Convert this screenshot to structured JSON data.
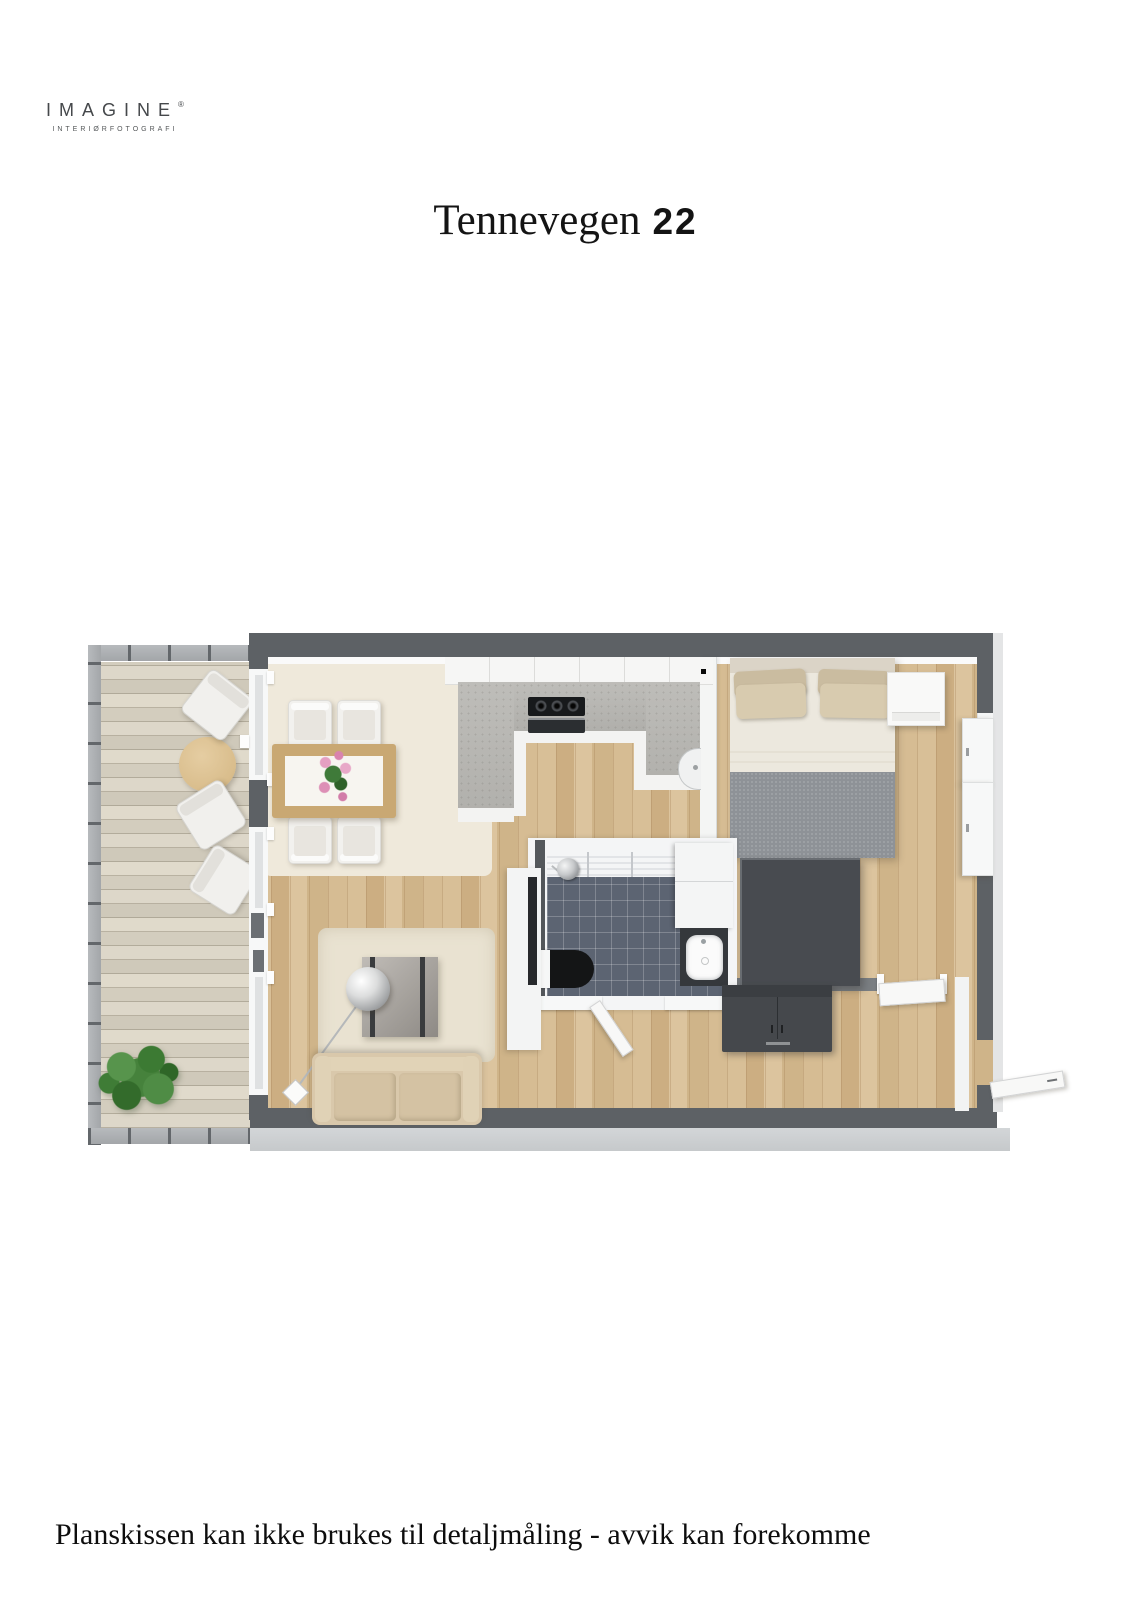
{
  "logo": {
    "brand": "IMAGINE",
    "registered": "®",
    "tagline": "INTERIØRFOTOGRAFI"
  },
  "title": {
    "street": "Tennevegen",
    "number": "22"
  },
  "disclaimer": {
    "text": "Planskissen kan ikke brukes til detaljmåling - avvik kan forekomme"
  },
  "palette": {
    "wall_dark": "#5d6165",
    "wall_face_light": "#ced1d3",
    "floor_oak": "#d3b98f",
    "deck_wood": "#d9d3c5",
    "bath_tile_blue_gray": "#5c6472",
    "dark_furniture": "#45484c",
    "sofa_beige": "#d9c8ab",
    "bed_blanket_gray": "#8e9297",
    "pillow_beige": "#d8cbaf",
    "rug_cream": "#efe9db",
    "plant_green": "#46823c",
    "kitchen_counter_gray": "#b8b7b3",
    "flower_pink": "#dd8fb6",
    "table_wood": "#c9a873"
  }
}
